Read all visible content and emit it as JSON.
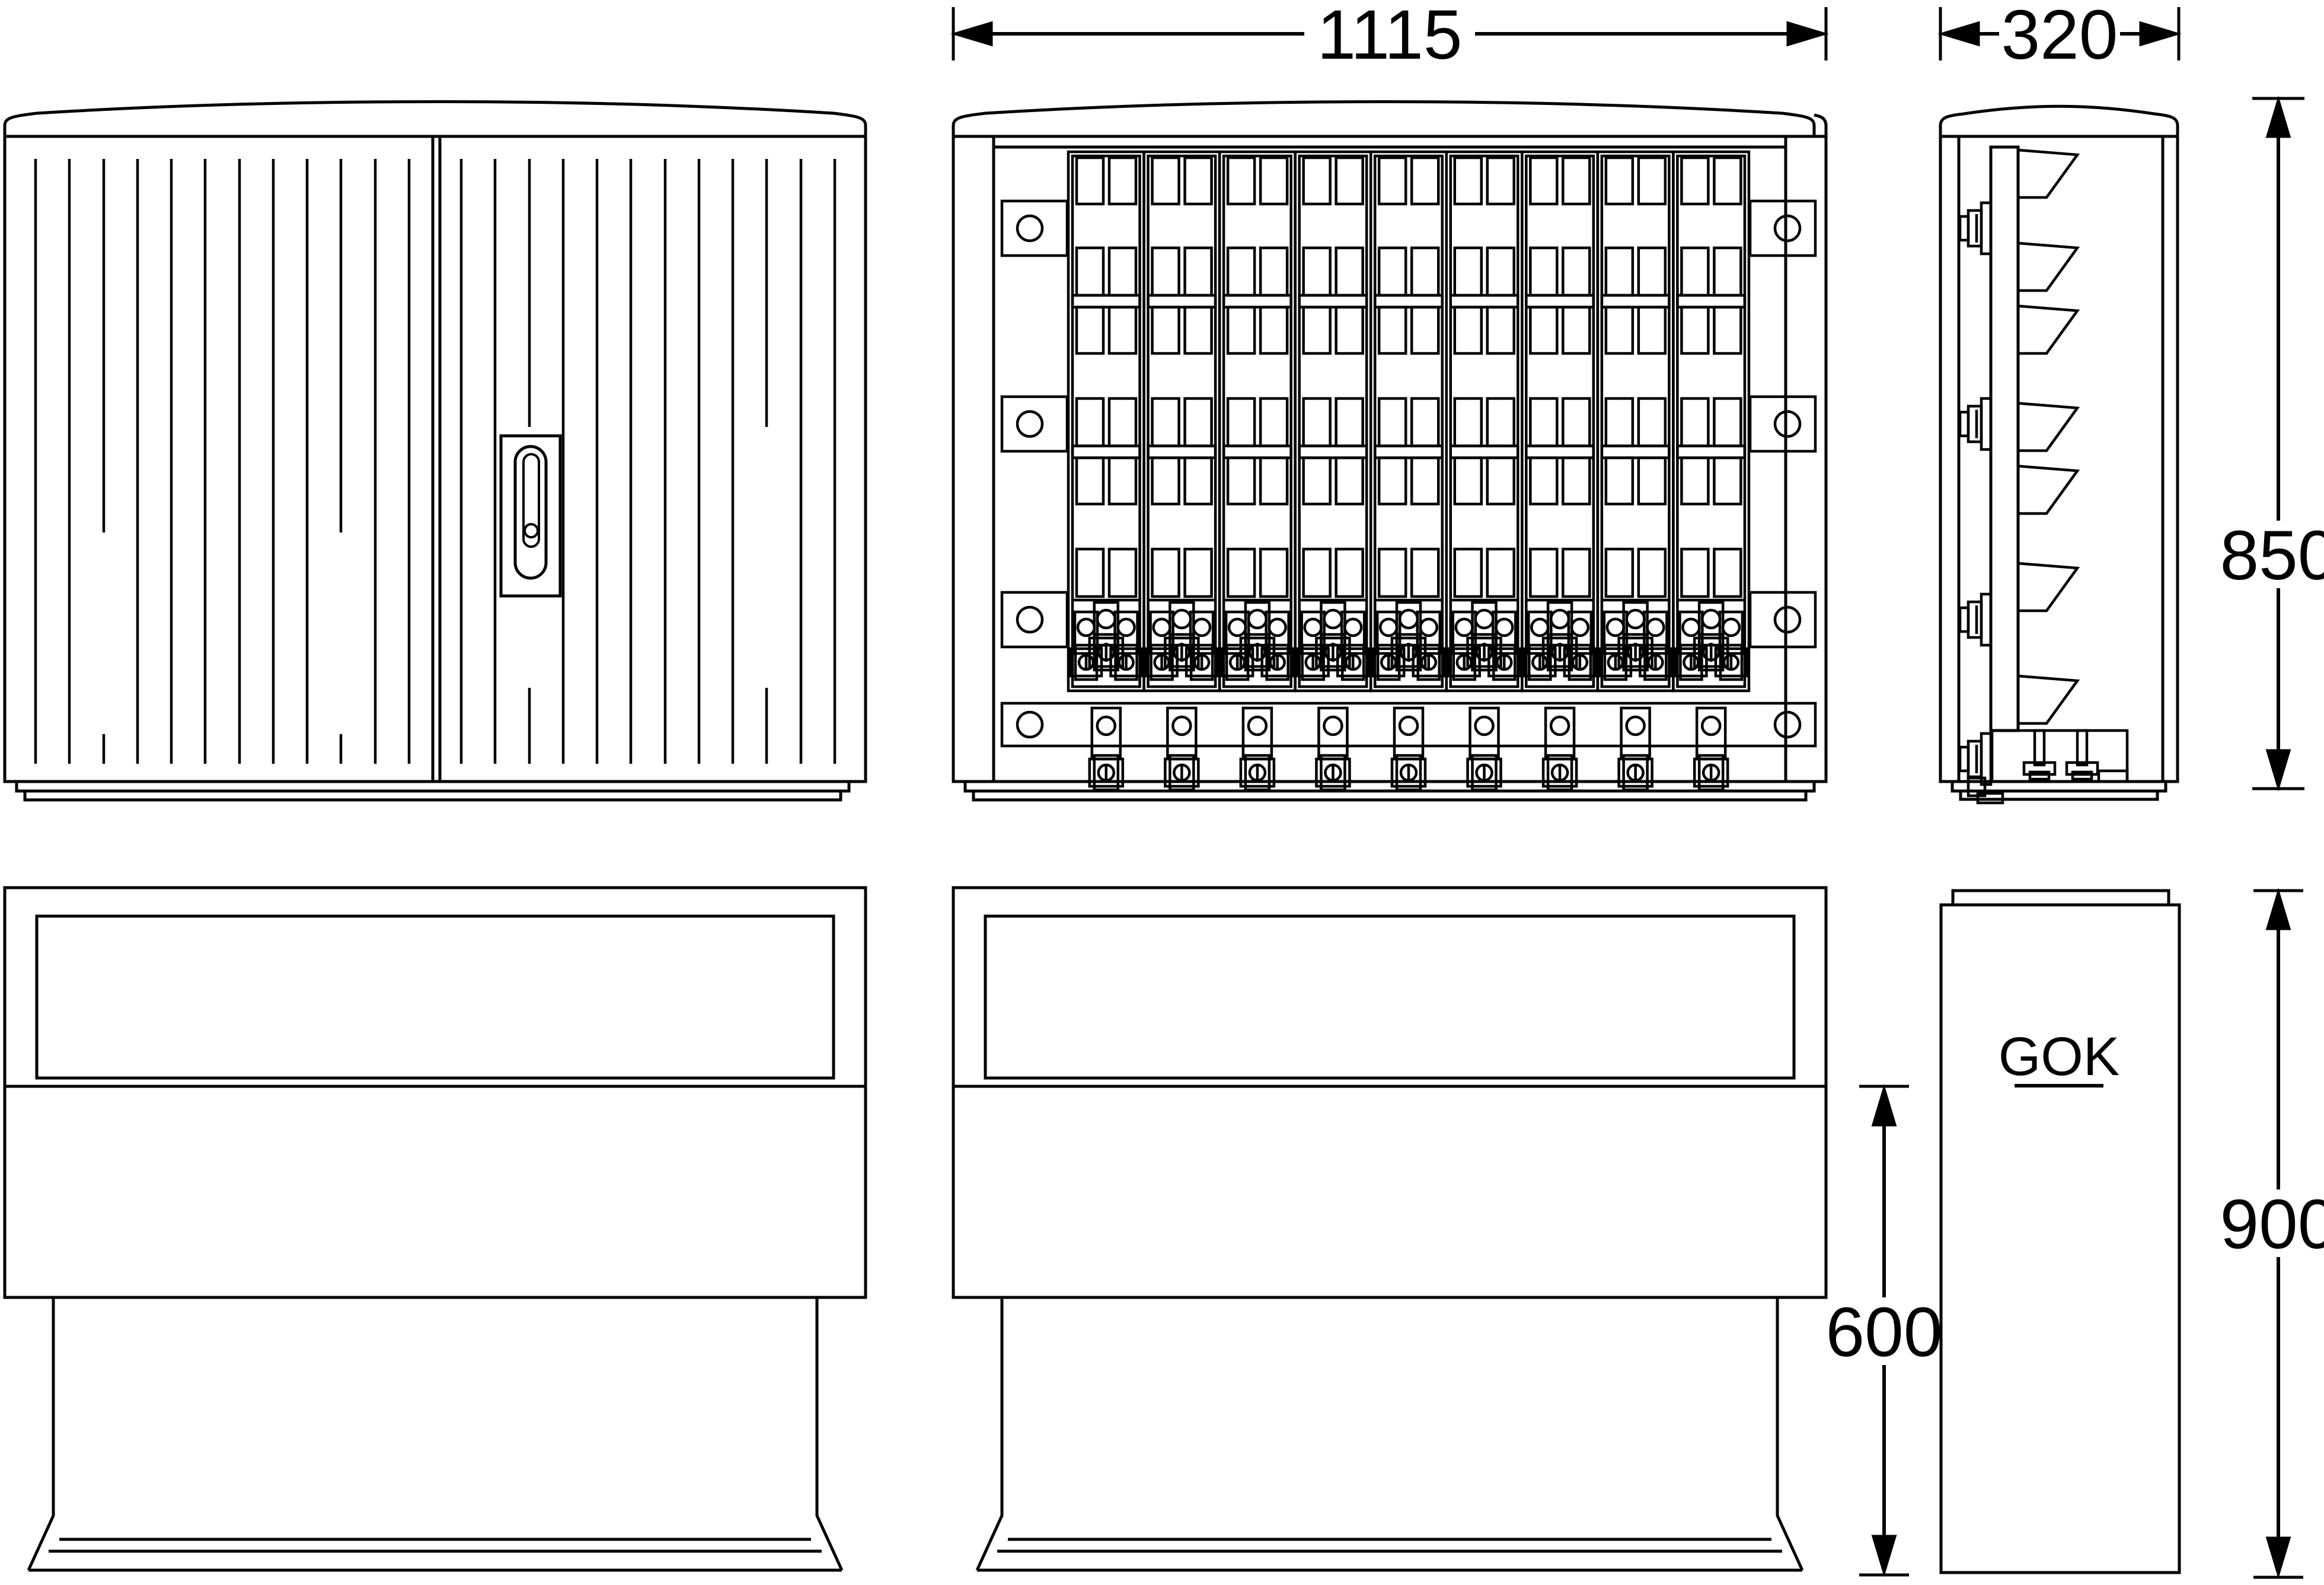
{
  "drawing": {
    "background": "#ffffff",
    "line_color": "#000000",
    "views": {
      "front_closed": "cable distribution cabinet - front view, doors closed",
      "front_open": "cable distribution cabinet - front view, doors open with 9 fuse strips",
      "side": "cable distribution cabinet - side view",
      "base_front": "foundation base - front view",
      "base_front_dim": "foundation base - front view with depth-in-ground dimension",
      "base_side": "foundation base - side view"
    },
    "dimensions": {
      "front_width": {
        "value": "1115"
      },
      "depth": {
        "value": "320"
      },
      "body_height": {
        "value": "850"
      },
      "base_exposed_height": {
        "value": "600"
      },
      "base_total_height": {
        "value": "900"
      }
    },
    "labels": {
      "ground_level": "GOK"
    }
  }
}
